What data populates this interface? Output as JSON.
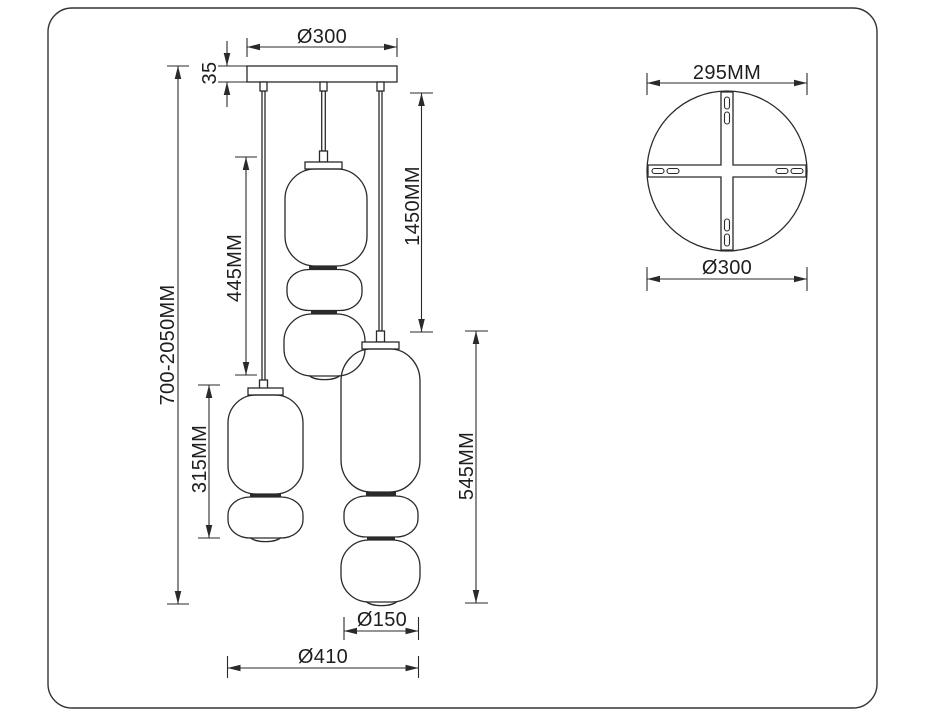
{
  "title": "Pendant light dimensional drawing",
  "colors": {
    "line": "#2a2a2a",
    "background": "#ffffff",
    "text": "#1e1e1e"
  },
  "front_view": {
    "canopy_diameter_label": "Ø300",
    "canopy_height_label": "35",
    "overall_height_label": "700-2050MM",
    "middle_pendant_height_label": "445MM",
    "suspension_drop_label": "1450MM",
    "left_pendant_height_label": "315MM",
    "right_pendant_height_label": "545MM",
    "shade_diameter_label": "Ø150",
    "cluster_width_label": "Ø410"
  },
  "top_view": {
    "bracket_width_label": "295MM",
    "canopy_diameter_label": "Ø300"
  }
}
